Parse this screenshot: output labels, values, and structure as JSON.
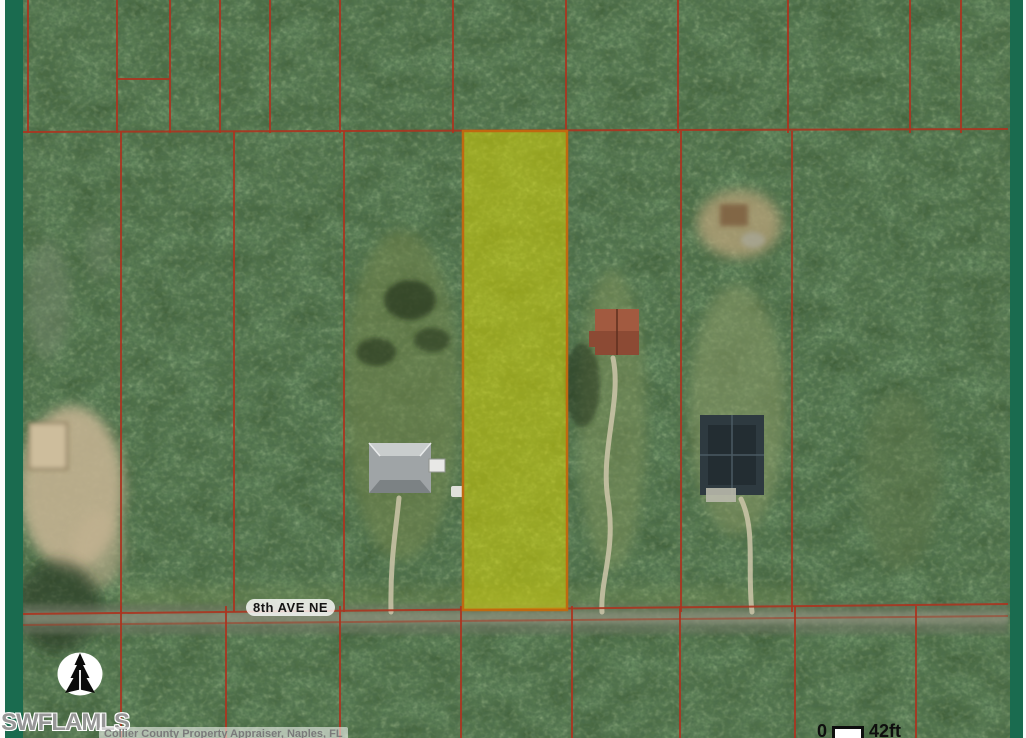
{
  "map": {
    "street_label": "8th AVE NE",
    "watermark": "SWFLAMLS",
    "attribution": "Collier County Property Appraiser, Naples, FL",
    "scale_bar": {
      "start": "0",
      "end": "42ft"
    },
    "icons": {
      "north_arrow": "north-arrow-icon"
    },
    "colors": {
      "frame_green": "#1a6b4f",
      "frame_white": "#fbfbfb",
      "parcel_line_red": "#ab3520",
      "highlight_fill": "#e0dc00",
      "highlight_border": "#bf6a10",
      "street_label_halo": "#ffffff",
      "watermark_gray": "#979797",
      "attribution_gray": "#7a7a7a"
    },
    "highlighted_parcel": {
      "x": 463,
      "y": 131,
      "width": 104,
      "height": 479
    },
    "parcel_lines": {
      "vertical_top": [
        28,
        117,
        170,
        220,
        270,
        340,
        453,
        566,
        678,
        788,
        910,
        961
      ],
      "vertical_middle": [
        121,
        234,
        344,
        681,
        792
      ],
      "vertical_bottom": [
        121,
        226,
        340,
        461,
        572,
        680,
        795,
        916
      ],
      "horizontal": [
        {
          "x1": 23,
          "y1": 132,
          "x2": 1008,
          "y2": 129
        },
        {
          "x1": 23,
          "y1": 614,
          "x2": 1008,
          "y2": 604
        },
        {
          "x1": 23,
          "y1": 625,
          "x2": 1008,
          "y2": 616,
          "opacity": 0.5
        },
        {
          "x1": 117,
          "y1": 79,
          "x2": 170,
          "y2": 79
        }
      ]
    }
  }
}
